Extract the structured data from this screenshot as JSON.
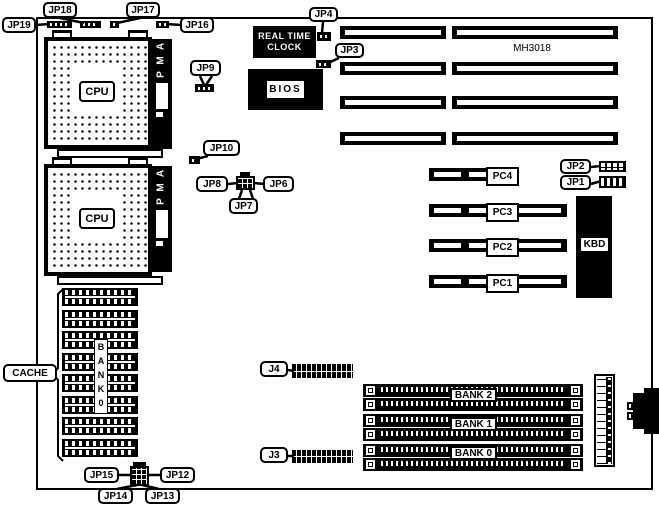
{
  "board": {
    "model": "MH3018"
  },
  "cpu": {
    "label": "CPU",
    "amp_letters": [
      "A",
      "M",
      "P"
    ]
  },
  "rtc": {
    "line1": "REAL TIME",
    "line2": "CLOCK"
  },
  "bios": {
    "label": "BIOS"
  },
  "kbd": {
    "label": "KBD"
  },
  "cache": {
    "label": "CACHE",
    "bank_letters": [
      "B",
      "A",
      "N",
      "K",
      "0"
    ]
  },
  "jumpers": {
    "jp1": "JP1",
    "jp2": "JP2",
    "jp3": "JP3",
    "jp4": "JP4",
    "jp6": "JP6",
    "jp7": "JP7",
    "jp8": "JP8",
    "jp9": "JP9",
    "jp10": "JP10",
    "jp12": "JP12",
    "jp13": "JP13",
    "jp14": "JP14",
    "jp15": "JP15",
    "jp16": "JP16",
    "jp17": "JP17",
    "jp18": "JP18",
    "jp19": "JP19"
  },
  "connectors": {
    "j3": "J3",
    "j4": "J4"
  },
  "pci": {
    "pc1": "PC1",
    "pc2": "PC2",
    "pc3": "PC3",
    "pc4": "PC4"
  },
  "memory": {
    "bank0": "BANK 0",
    "bank1": "BANK 1",
    "bank2": "BANK 2"
  }
}
